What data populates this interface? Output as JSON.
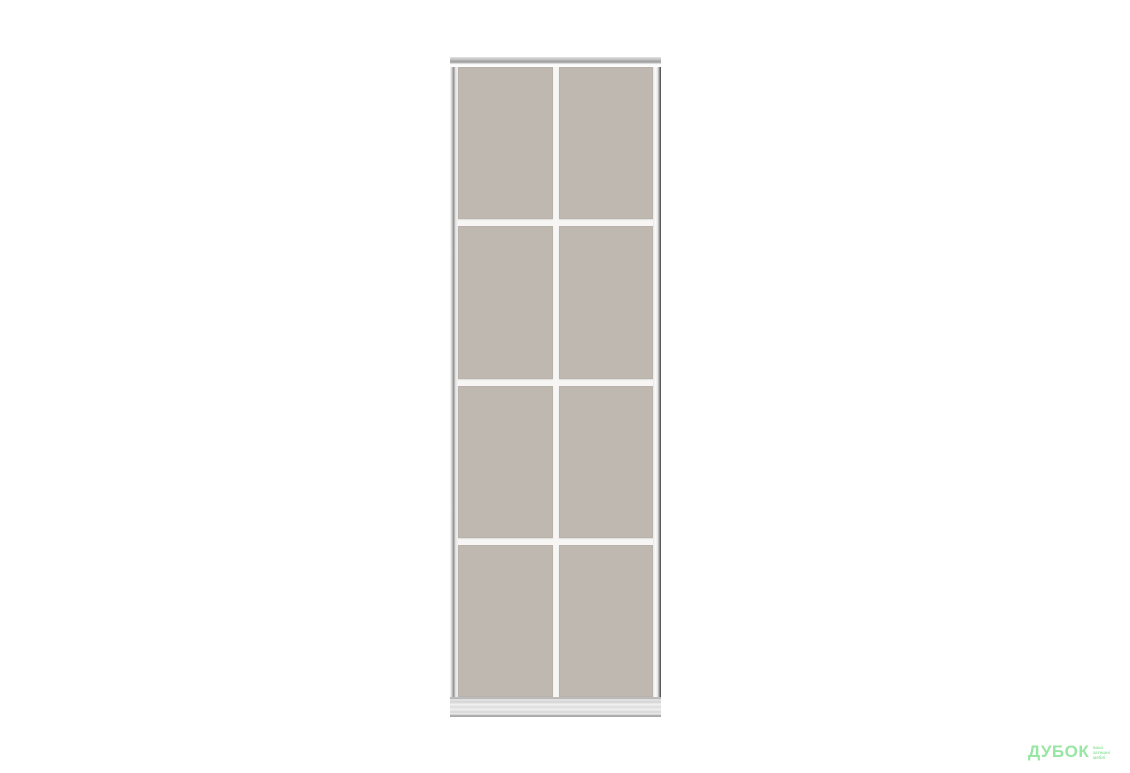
{
  "colors": {
    "background": "#ffffff",
    "panel": "#bfb8b1",
    "divider": "#f7f6f4",
    "frame_light": "#ededed",
    "frame_mid": "#9b9b9b",
    "frame_dark": "#3f3f3f",
    "rail_metal": "#d6d6d6",
    "logo_green": "#98e6a4"
  },
  "product": {
    "kind": "sliding-wardrobe-door",
    "rows": 4,
    "columns": 2
  },
  "watermark": {
    "brand": "ДУБОК",
    "tagline_lines": [
      "ваші",
      "затишні",
      "меблі"
    ]
  }
}
